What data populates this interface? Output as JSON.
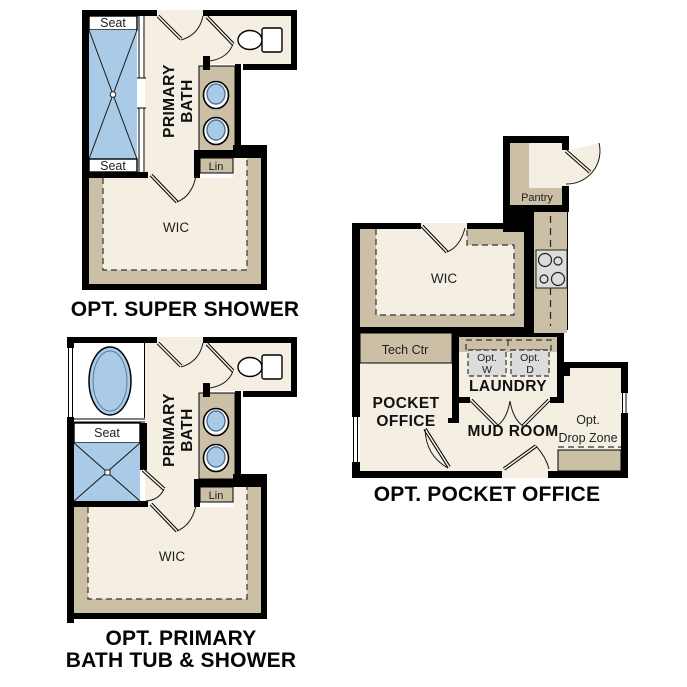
{
  "colors": {
    "wall": "#000000",
    "floor": "#F5EFE3",
    "cabinet_tan": "#CBBFA6",
    "fixture_blue": "#A9CBE7",
    "appliance_gray": "#DCDCDC",
    "background": "#FFFFFF",
    "text": "#1F1F1F"
  },
  "plans": {
    "super_shower": {
      "caption": "OPT. SUPER SHOWER",
      "labels": {
        "seat_top": "Seat",
        "seat_bottom": "Seat",
        "primary_bath_line1": "PRIMARY",
        "primary_bath_line2": "BATH",
        "lin": "Lin",
        "wic": "WIC"
      }
    },
    "tub_shower": {
      "caption_line1": "OPT. PRIMARY",
      "caption_line2": "BATH TUB & SHOWER",
      "labels": {
        "seat": "Seat",
        "primary_bath_line1": "PRIMARY",
        "primary_bath_line2": "BATH",
        "lin": "Lin",
        "wic": "WIC"
      }
    },
    "pocket_office": {
      "caption": "OPT. POCKET OFFICE",
      "labels": {
        "pantry": "Pantry",
        "wic": "WIC",
        "tech_ctr": "Tech Ctr",
        "pocket_line1": "POCKET",
        "pocket_line2": "OFFICE",
        "laundry": "LAUNDRY",
        "washer_line1": "Opt.",
        "washer_line2": "W",
        "dryer_line1": "Opt.",
        "dryer_line2": "D",
        "mud_room": "MUD ROOM",
        "drop_zone_line1": "Opt.",
        "drop_zone_line2": "Drop Zone"
      }
    }
  }
}
